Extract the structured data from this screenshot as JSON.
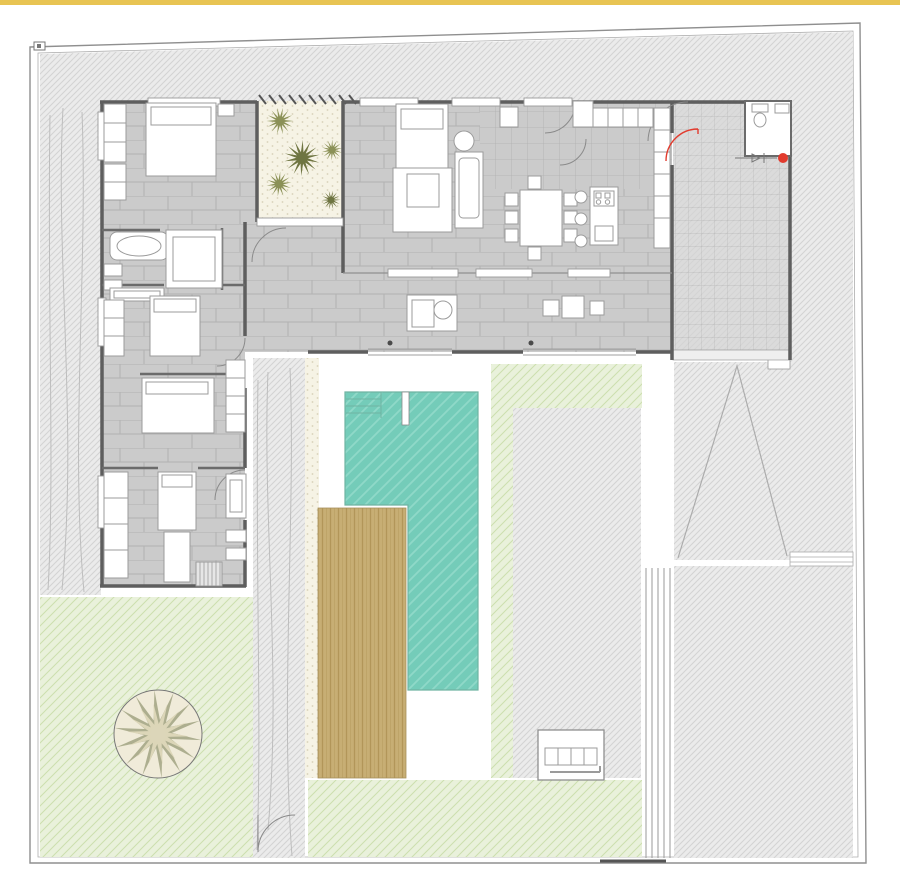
{
  "document": {
    "kind": "architectural-floor-plan",
    "visible_text": "none"
  },
  "palette": {
    "top_bar": "#E8C453",
    "paper": "#FFFFFF",
    "boundary_line": "#8F8F8F",
    "boundary_line_inner": "#ADADAD",
    "terrain_fill": "#EBEBEB",
    "terrain_line": "#D3D3D3",
    "floor_fill": "#CBCBCB",
    "floor_joint": "#B1B1B1",
    "garage_fill": "#D3D3D3",
    "garage_line": "#ABABAB",
    "wall": "#5E5E5E",
    "partition": "#6B6B6B",
    "courtyard_fill": "#F6F3E5",
    "courtyard_dot": "#D8D2B9",
    "palm_olive": "#8B9157",
    "palm_dark_olive": "#6F7542",
    "lawn_palm_spikes": "#A6A887",
    "lawn_palm_core": "#DCD6B8",
    "pool_fill": "#74CCB9",
    "pool_line": "#8FD9C8",
    "pool_edge": "#6FB3A2",
    "deck_fill": "#C7AE74",
    "deck_line": "#B29659",
    "lawn_fill": "#E9F1DB",
    "lawn_line": "#CCDFAE",
    "fixture_line": "#9B9B9B",
    "arc_line": "#8A8A8A",
    "accent_red": "#E23B2E",
    "dot_dark": "#4A4A4A"
  },
  "regions": {
    "perimeter_terrain": "hatched terrain around plot",
    "left_path": "side path with ground curves",
    "middle_path": "garden path with gate arc",
    "bedroom_1": "bedroom with bed and closets",
    "bathroom": "bathroom with bathtub",
    "bedroom_2": "bedroom with dresser",
    "bedroom_3": "bedroom",
    "bedroom_4": "master bedroom with desk and stairs",
    "inner_courtyard": "planted patio with palms",
    "living_room": "sofa group and chaise",
    "dining_area": "table with eight chairs",
    "kitchen": "island, stools, cooktop, cabinets",
    "terrace_band": "covered terrace with seats and side tables",
    "entry_court": "tiled entry / carport court",
    "wc": "guest toilet",
    "pool_courtyard": "pool terrace",
    "pool": "L-shaped swimming pool with steps",
    "wood_deck": "timber deck",
    "lawn_main": "lawn with large palm",
    "lawn_strips": "lawn borders at pool",
    "gray_patio": "paved patio by pool",
    "outdoor_kitchen": "barbecue counter",
    "driveway_ramp": "ramp with chevron marking",
    "rear_court": "rear paved court",
    "entry_gate_marker": "red entry dot and gate symbol"
  },
  "markers": {
    "entry_dot": "red circle at entrance",
    "floor_drains": 2,
    "courtyard_palm_count": 5,
    "lawn_palm_count": 1
  }
}
